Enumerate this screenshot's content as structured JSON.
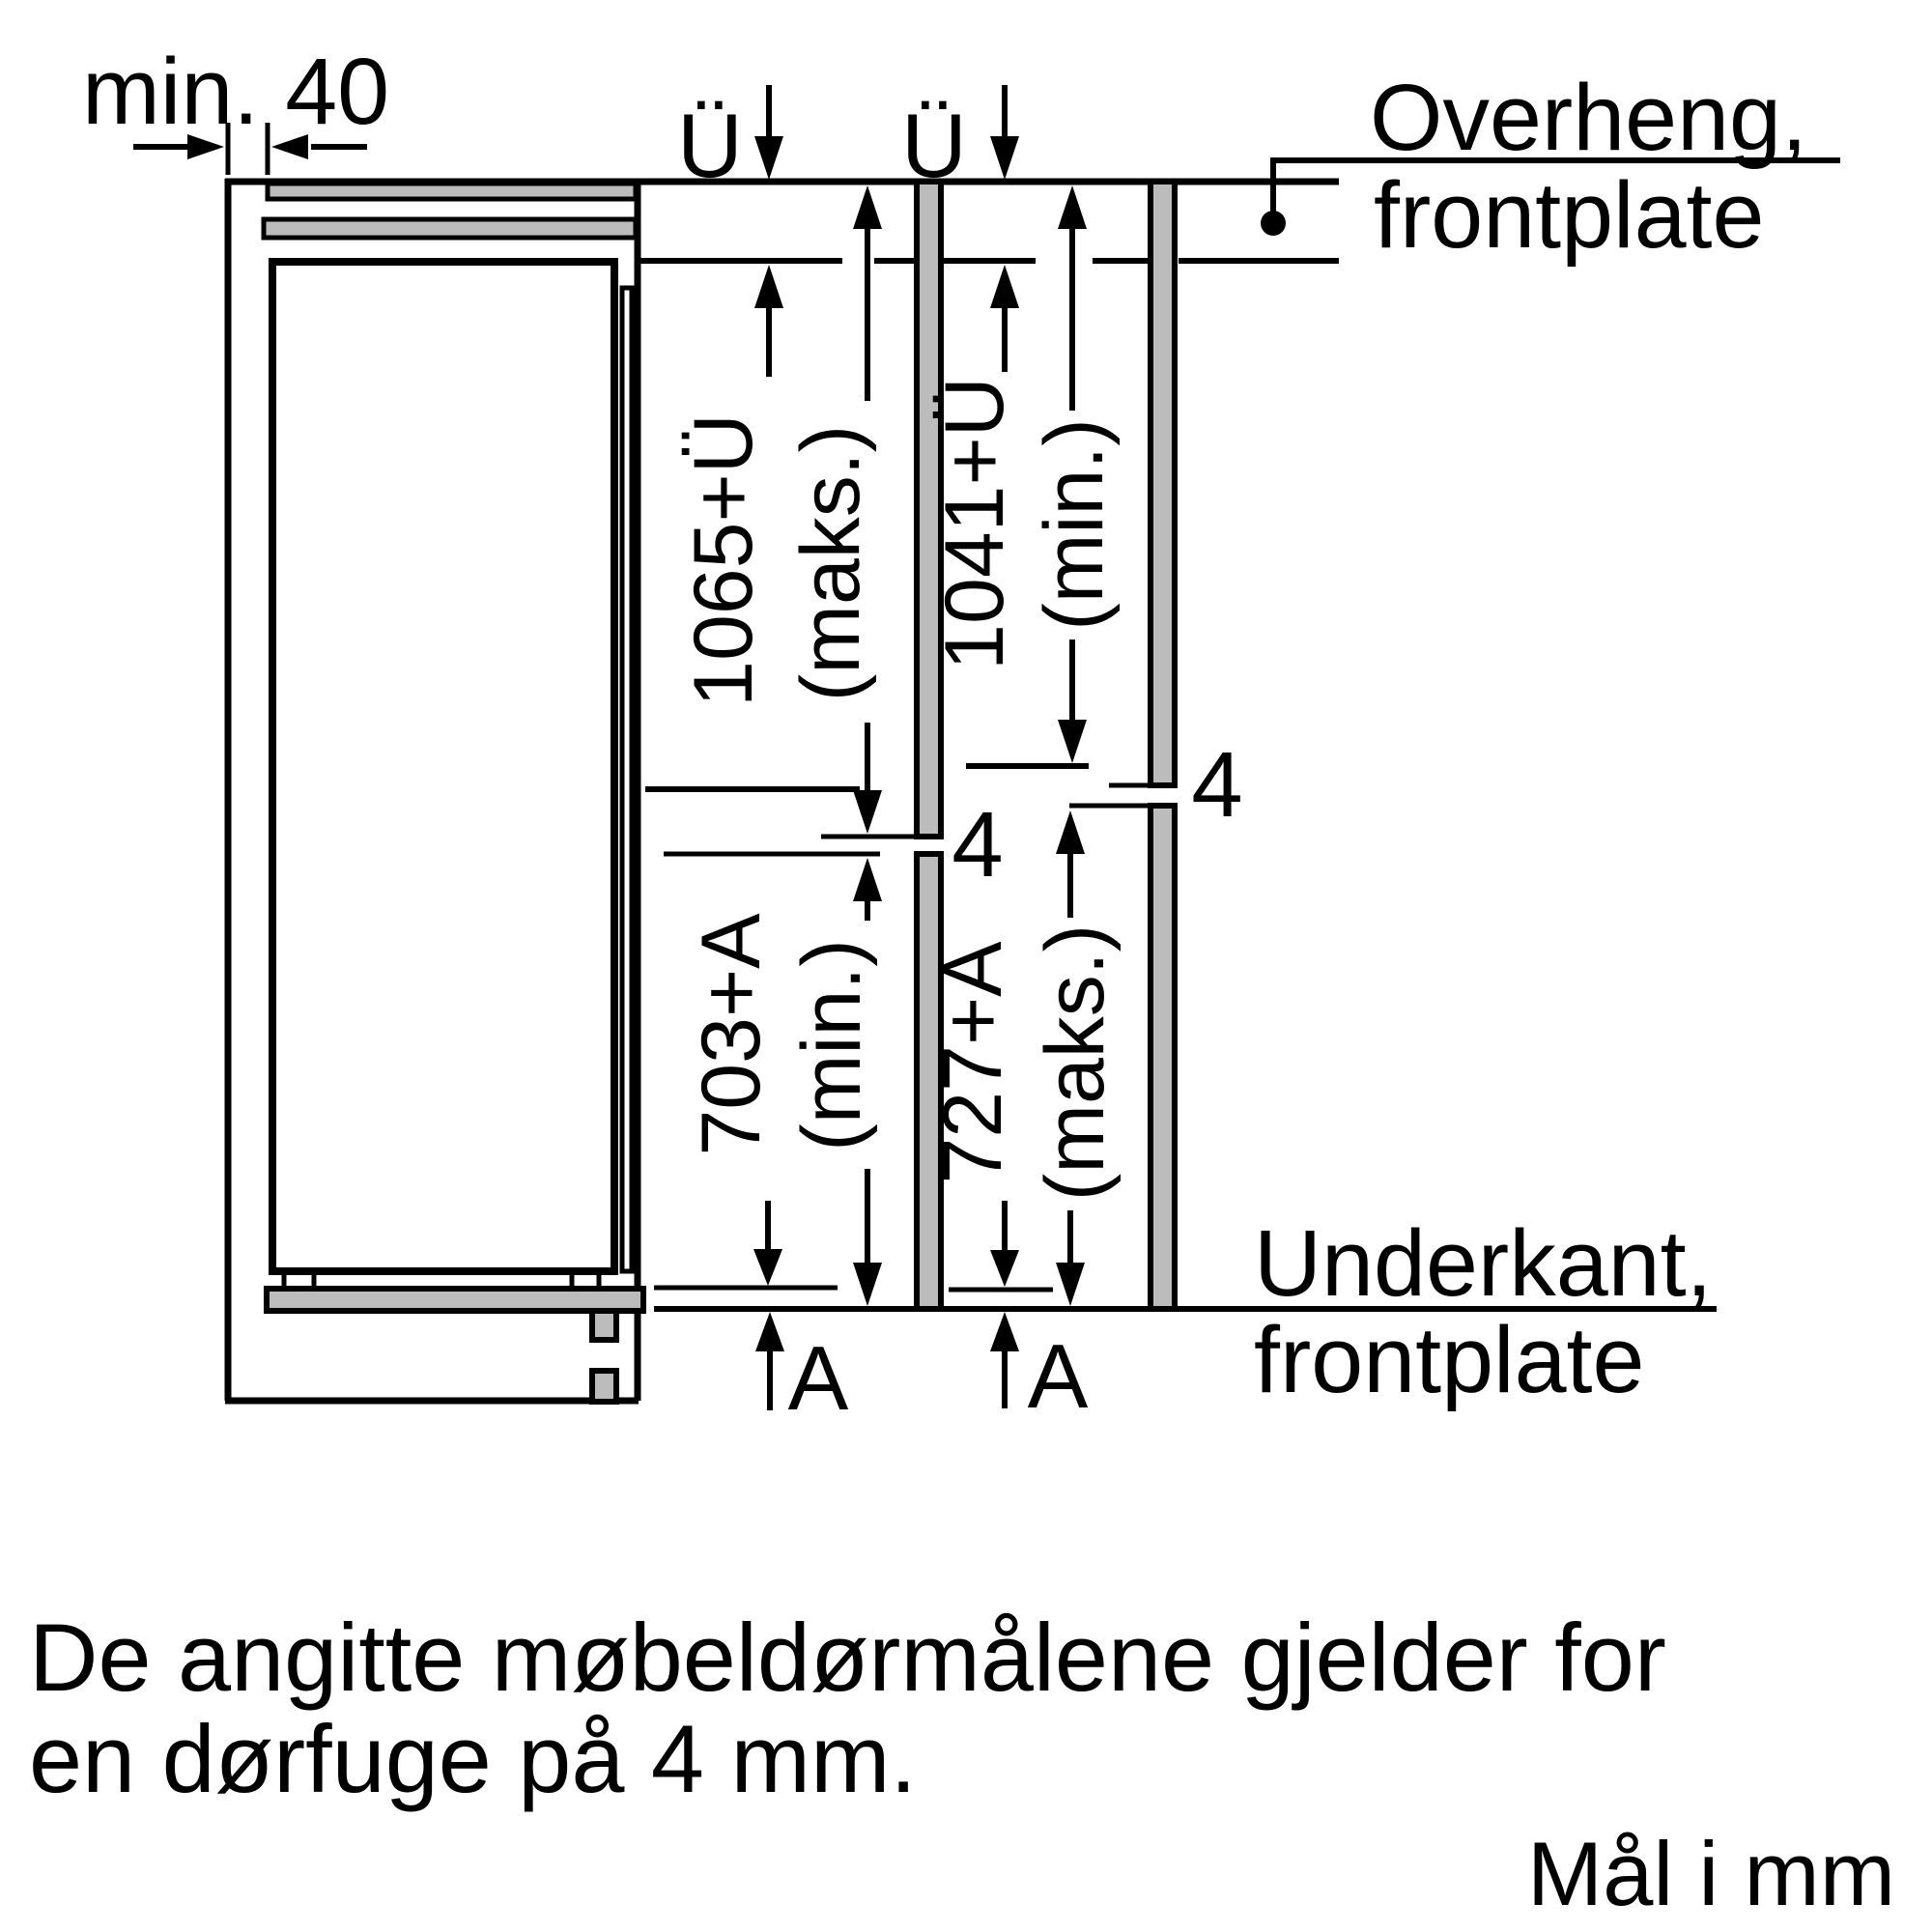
{
  "diagram_title": "built-in-fridge-niche-dimensions",
  "dims": {
    "top_clearance": "min. 40",
    "overhang_symbol": "Ü",
    "gap_value": "4",
    "recess_symbol": "A",
    "upper_max": "1065+Ü",
    "upper_max_qual": "(maks.)",
    "upper_min": "1041+Ü",
    "upper_min_qual": "(min.)",
    "lower_min": "703+A",
    "lower_min_qual": "(min.)",
    "lower_max": "727+A",
    "lower_max_qual": "(maks.)"
  },
  "callouts": {
    "overhang": {
      "line1": "Overheng,",
      "line2": "frontplate"
    },
    "bottom_edge": {
      "line1": "Underkant,",
      "line2": "frontplate"
    }
  },
  "notes": {
    "line1": "De angitte møbeldørmålene gjelder for",
    "line2": "en dørfuge på 4 mm.",
    "units": "Mål i mm"
  },
  "colors": {
    "ink": "#000000",
    "panel_gray": "#bcbcbc",
    "background": "#ffffff"
  }
}
